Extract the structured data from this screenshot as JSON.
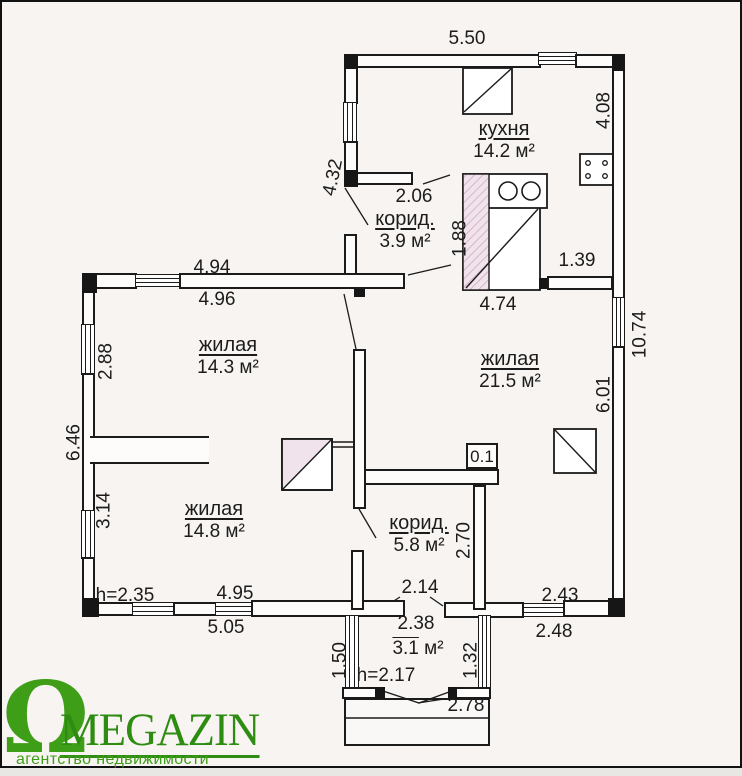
{
  "dims": {
    "w550": "5.50",
    "w408": "4.08",
    "w432": "4.32",
    "w206": "2.06",
    "w188": "1.88",
    "w139": "1.39",
    "w474": "4.74",
    "w1074": "10.74",
    "w494": "4.94",
    "w496": "4.96",
    "w288": "2.88",
    "w646": "6.46",
    "w314": "3.14",
    "w601": "6.01",
    "w270": "2.70",
    "w214": "2.14",
    "w243": "2.43",
    "w248": "2.48",
    "w238": "2.38",
    "h235": "h=2.35",
    "w495": "4.95",
    "w505": "5.05",
    "h217": "h=2.17",
    "w150": "1.50",
    "w132": "1.32",
    "w278": "2.78",
    "w01": "0.1"
  },
  "rooms": {
    "kitchen": {
      "name": "кухня",
      "area": "14.2 м²"
    },
    "hall": {
      "name": "корид.",
      "area": "3.9 м²"
    },
    "living1": {
      "name": "жилая",
      "area": "14.3 м²"
    },
    "living2": {
      "name": "жилая",
      "area": "21.5 м²"
    },
    "living3": {
      "name": "жилая",
      "area": "14.8 м²"
    },
    "corridor": {
      "name": "корид.",
      "area": "5.8 м²"
    },
    "porch": {
      "area_value": "3.1",
      "area_unit": "м²"
    }
  },
  "logo": {
    "omega": "Ω",
    "brand": "MEGAZIN",
    "tagline": "агентство недвижимости",
    "green": "#2e8c12"
  },
  "colors": {
    "hatch_pink": "#f0e3ec",
    "line": "#1b1b1b"
  }
}
